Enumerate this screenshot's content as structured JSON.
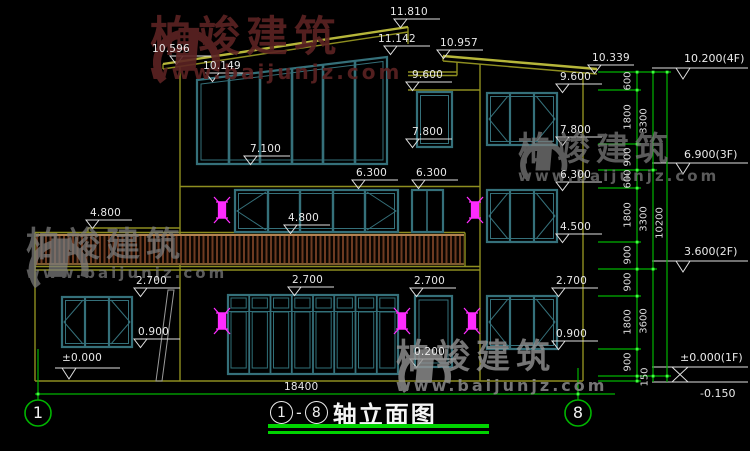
{
  "watermark": {
    "brand": "柏竣建筑",
    "site": "www.baijunjz.com"
  },
  "labels": {
    "e11810": "11.810",
    "e11142": "11.142",
    "e10957": "10.957",
    "e10596": "10.596",
    "e10339": "10.339",
    "e10149": "10.149",
    "e9600": "9.600",
    "e7800": "7.800",
    "e7100": "7.100",
    "e6300": "6.300",
    "e4800": "4.800",
    "e4500": "4.500",
    "e2700": "2.700",
    "e0900": "0.900",
    "e0200": "0.200",
    "e0000": "±0.000",
    "f4": "10.200(4F)",
    "f3": "6.900(3F)",
    "f2": "3.600(2F)",
    "f1": "±0.000(1F)",
    "fb": "-0.150",
    "total": "18400"
  },
  "chain": {
    "col1": [
      "600",
      "1800",
      "900",
      "600",
      "1800",
      "900",
      "900",
      "1800",
      "900",
      "150"
    ],
    "col2": [
      "3300",
      "3300",
      "3600"
    ],
    "col3": [
      "10200"
    ]
  },
  "axes": {
    "left": "1",
    "right": "8"
  },
  "title": {
    "start": "1",
    "dash": "-",
    "end": "8",
    "text": "轴立面图"
  }
}
